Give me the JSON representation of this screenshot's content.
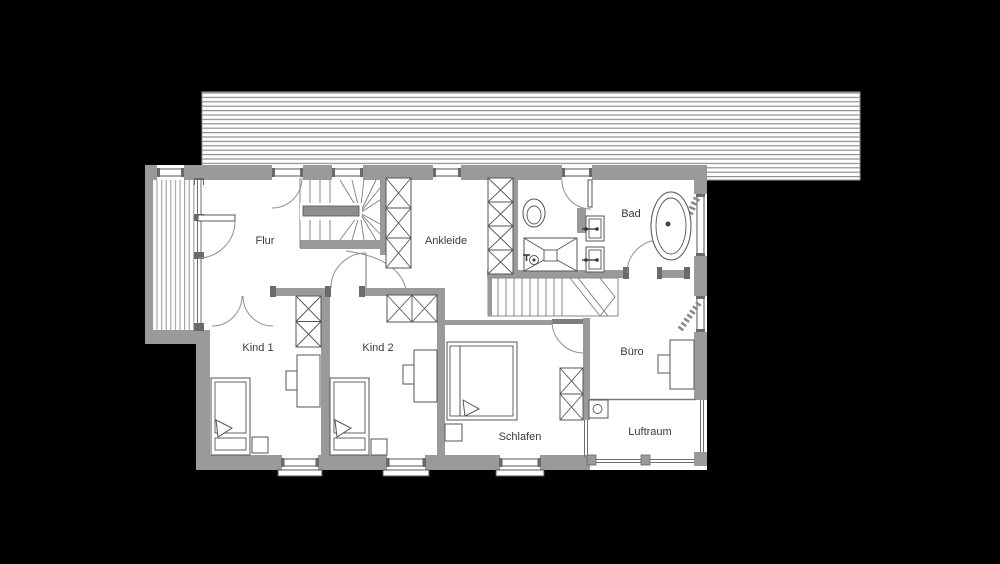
{
  "drawing": {
    "type": "floor-plan",
    "floor_label": ""
  },
  "rooms": {
    "flur": {
      "label": "Flur"
    },
    "ankleide": {
      "label": "Ankleide"
    },
    "bad": {
      "label": "Bad"
    },
    "kind1": {
      "label": "Kind 1"
    },
    "kind2": {
      "label": "Kind 2"
    },
    "buero": {
      "label": "Büro"
    },
    "schlafen": {
      "label": "Schlafen"
    },
    "luftraum": {
      "label": "Luftraum"
    }
  },
  "colors": {
    "bg": "#000000",
    "paper": "#ffffff",
    "wall": "#9a9a9a",
    "dark": "#6a6a6a",
    "line": "#555555",
    "arc": "#909090",
    "text": "#3a3a3a"
  }
}
